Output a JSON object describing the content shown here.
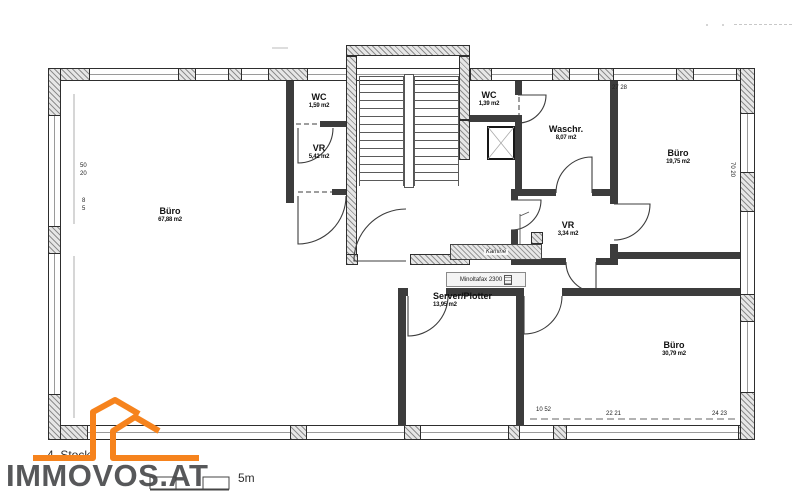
{
  "plan": {
    "floor_label": "4. Stock",
    "scale_label": "5m",
    "fax_label": "Minoltafax 2300",
    "chimney_label": "Kamine"
  },
  "rooms": [
    {
      "name": "Büro",
      "area": "67,88 m2"
    },
    {
      "name": "WC",
      "area": "1,59 m2"
    },
    {
      "name": "VR",
      "area": "5,42 m2"
    },
    {
      "name": "WC",
      "area": "1,39 m2"
    },
    {
      "name": "Waschr.",
      "area": "8,07 m2"
    },
    {
      "name": "Büro",
      "area": "19,75 m2"
    },
    {
      "name": "VR",
      "area": "3,34 m2"
    },
    {
      "name": "Server/Plotter",
      "area": "13,95 m2"
    },
    {
      "name": "Büro",
      "area": "30,79 m2"
    }
  ],
  "dimensions": {
    "left_upper": "50",
    "left_upper2": "20",
    "left_lower": "8",
    "left_lower2": "5",
    "top_right": "27  28",
    "right_side": "70  20",
    "bottom_center": "10 52",
    "bottom_mid": "22 21",
    "bottom_right": "24 23"
  },
  "logo": {
    "text": "IMMOVOS.AT",
    "accent_color": "#f6831d",
    "text_color": "#57585a"
  }
}
